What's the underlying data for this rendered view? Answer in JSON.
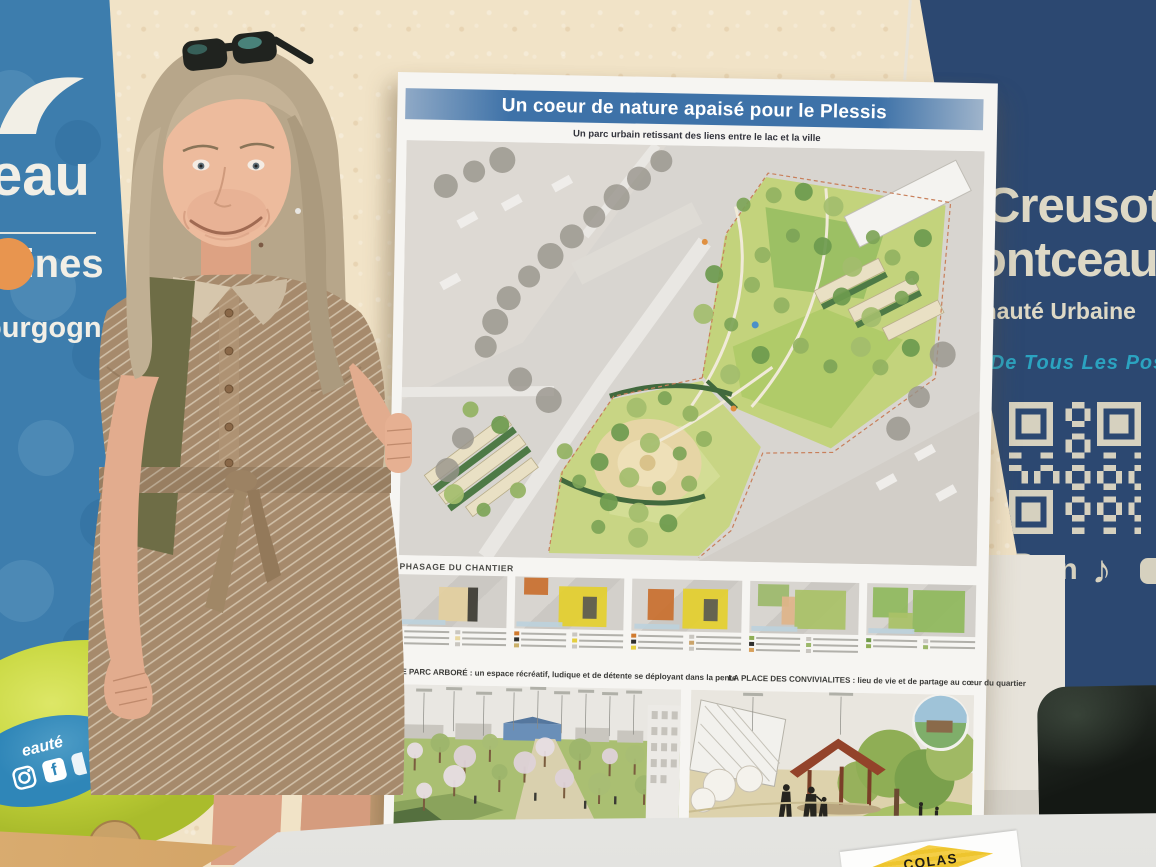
{
  "left_banner": {
    "word1": "eau",
    "word2": "mines",
    "word3": "ourgogne",
    "bg_color": "#3d7dad",
    "accent_orange": "#e8954f",
    "logo": "wave-logo"
  },
  "balloon_sticker": {
    "text": "eauté",
    "facebook_label": "f",
    "icons": [
      "instagram-icon",
      "facebook-icon"
    ]
  },
  "poster": {
    "title": "Un coeur de nature apaisé pour le Plessis",
    "subtitle": "Un parc urbain retissant des liens entre le lac et la ville",
    "phasage_label": "PHASAGE DU CHANTIER",
    "section_left": "LE PARC ARBORÉ : un espace récréatif, ludique et de détente se déployant dans la pente",
    "section_right": "LA PLACE DES CONVIVIALITES : lieu de vie et de partage au cœur du quartier",
    "title_bar_color": "#3e72a8",
    "phases": [
      {
        "overlays": [
          {
            "l": 38,
            "t": 24,
            "w": 34,
            "h": 64,
            "c": "#e3cfa0"
          },
          {
            "l": 64,
            "t": 24,
            "w": 9,
            "h": 64,
            "c": "#3a3a35"
          }
        ],
        "legend_left": [
          "#d89a5a",
          "#2f2f2d",
          "#caa36a"
        ],
        "legend_right": [
          "#c9c6c0",
          "#e8d7a0",
          "#c9c6c0"
        ]
      },
      {
        "overlays": [
          {
            "l": 8,
            "t": 2,
            "w": 22,
            "h": 32,
            "c": "#c96f2e"
          },
          {
            "l": 40,
            "t": 18,
            "w": 44,
            "h": 76,
            "c": "#e4cf2e"
          },
          {
            "l": 62,
            "t": 36,
            "w": 13,
            "h": 42,
            "c": "#5a5a52"
          }
        ],
        "legend_left": [
          "#d07a2e",
          "#2f2f2d",
          "#cab06a"
        ],
        "legend_right": [
          "#c9c6c0",
          "#e5cf3e",
          "#c9c6c0"
        ]
      },
      {
        "overlays": [
          {
            "l": 14,
            "t": 20,
            "w": 24,
            "h": 58,
            "c": "#c96f2e"
          },
          {
            "l": 46,
            "t": 18,
            "w": 42,
            "h": 76,
            "c": "#e4cf2e"
          },
          {
            "l": 66,
            "t": 36,
            "w": 12,
            "h": 42,
            "c": "#5a5a52"
          }
        ],
        "legend_left": [
          "#d07a2e",
          "#2f2f2d",
          "#e5cf3e"
        ],
        "legend_right": [
          "#c9c6c0",
          "#caa36a",
          "#c9c6c0"
        ]
      },
      {
        "overlays": [
          {
            "l": 8,
            "t": 6,
            "w": 28,
            "h": 42,
            "c": "#9cb86a"
          },
          {
            "l": 42,
            "t": 16,
            "w": 46,
            "h": 74,
            "c": "#a9c167"
          },
          {
            "l": 30,
            "t": 28,
            "w": 12,
            "h": 54,
            "c": "#e0b48a"
          }
        ],
        "legend_left": [
          "#8fae55",
          "#2f2f2d",
          "#d8a05a"
        ],
        "legend_right": [
          "#c9c6c0",
          "#9cb86a",
          "#c9c6c0"
        ]
      },
      {
        "overlays": [
          {
            "l": 6,
            "t": 8,
            "w": 32,
            "h": 58,
            "c": "#8fb95c"
          },
          {
            "l": 42,
            "t": 12,
            "w": 48,
            "h": 80,
            "c": "#8fb95c"
          },
          {
            "l": 20,
            "t": 56,
            "w": 22,
            "h": 32,
            "c": "#a9c167"
          }
        ],
        "legend_left": [
          "#6f9a4a",
          "#8fae55"
        ],
        "legend_right": [
          "#c9c6c0",
          "#9cb86a"
        ]
      }
    ]
  },
  "right_banner": {
    "line1": "Creusot",
    "line2": "Montceau",
    "line3": "Communauté Urbaine",
    "tagline": "Terre De Tous Les Possibles",
    "bottom_text": "De Tous Les",
    "linkedin_label": "in",
    "tiktok_glyph": "♪",
    "bg_color": "#2c4871",
    "text_color": "#ded9c6",
    "tagline_color": "#2ba3c0",
    "icons": [
      "instagram-icon",
      "linkedin-icon",
      "tiktok-icon",
      "youtube-icon"
    ]
  },
  "colas_sign": {
    "label": "COLAS",
    "diamond_color": "#f0c83c"
  }
}
